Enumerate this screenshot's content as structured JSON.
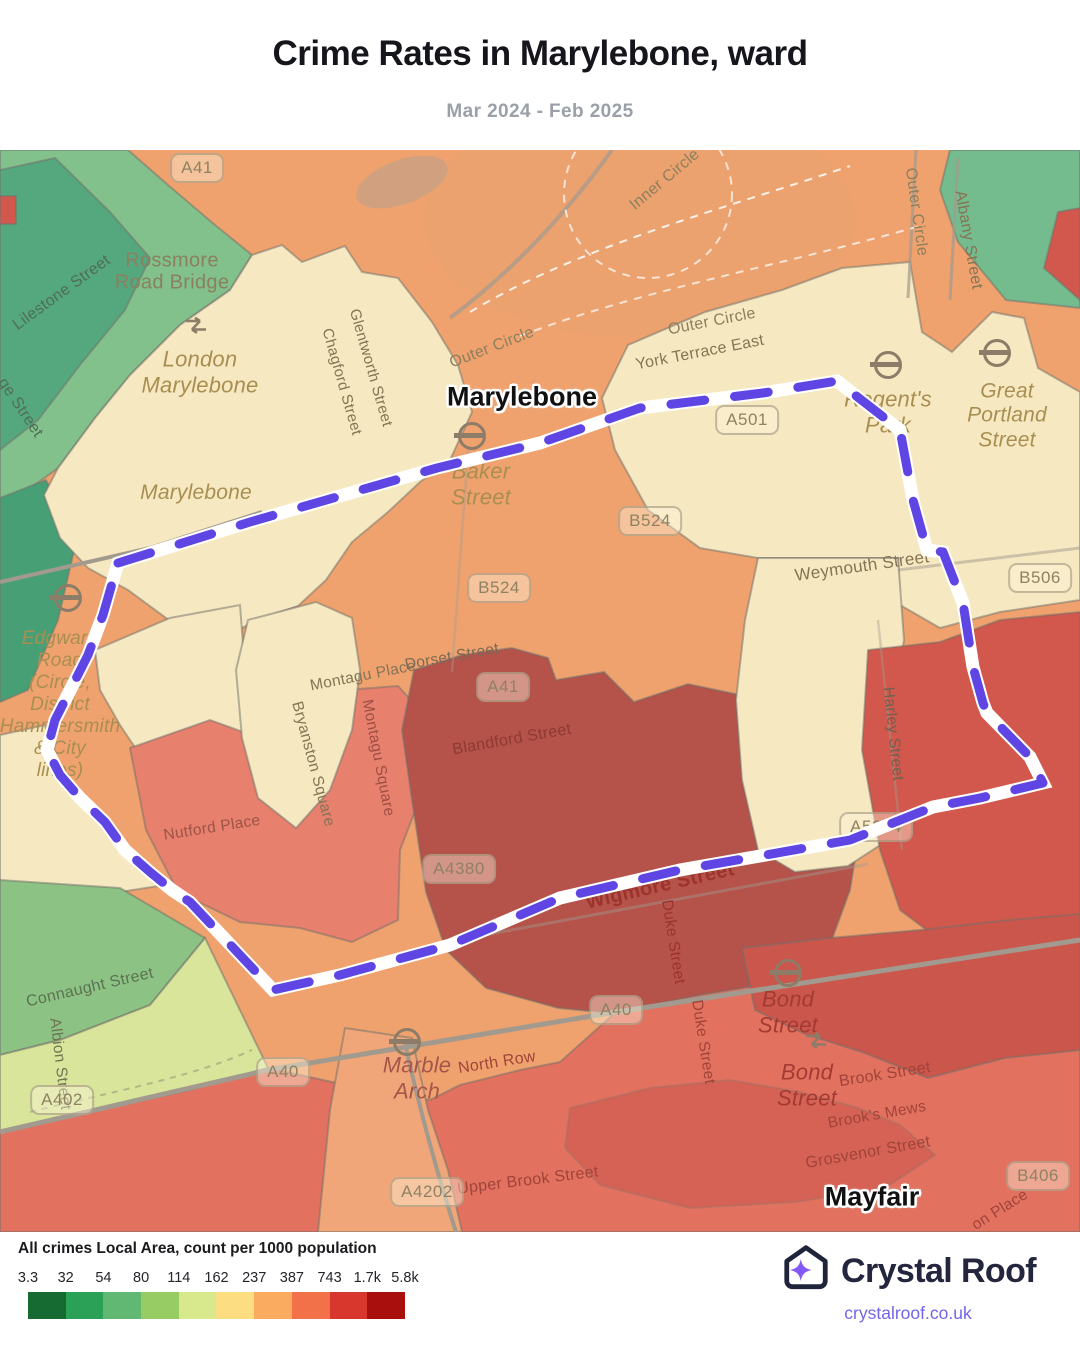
{
  "header": {
    "title": "Crime Rates in Marylebone, ward",
    "subtitle": "Mar 2024 - Feb 2025"
  },
  "map": {
    "colors": {
      "orange": "#efa26e",
      "orange_wedge": "#f0a678",
      "park": "#e7a371",
      "lake": "#c9a183",
      "cream": "#f6e8c0",
      "green_light": "#82c18c",
      "green_teal": "#55a87d",
      "green_dark": "#47a075",
      "green_tr": "#74bc8e",
      "green_bl": "#8cc384",
      "yellow_green": "#d8e59b",
      "salmon": "#e2715f",
      "salmon_light": "#e8806e",
      "red_dark": "#b5524a",
      "red_mid": "#d2574c",
      "red_bond": "#cb564c",
      "outline": "#70706a",
      "road": "#a29a8e",
      "path_dash": "#ffffff",
      "boundary": "#5e45e4",
      "boundary_casing": "#ffffff"
    },
    "area_labels": [
      {
        "n": "marylebone-area-label",
        "t": "Marylebone",
        "x": 522,
        "y": 247,
        "s": 27
      },
      {
        "n": "mayfair-area-label",
        "t": "Mayfair",
        "x": 872,
        "y": 1047,
        "s": 27
      }
    ],
    "street_labels": [
      {
        "n": "lilestone-street-label",
        "t": "Lilestone Street",
        "x": 62,
        "y": 143,
        "r": -36,
        "c": "#4f6e55",
        "s": 16
      },
      {
        "n": "ge-street-label",
        "t": "ge Street",
        "x": 20,
        "y": 258,
        "r": 56,
        "c": "#4f6e55",
        "s": 16
      },
      {
        "n": "rossmore-road-bridge-label",
        "t": "Rossmore\nRoad Bridge",
        "x": 172,
        "y": 122,
        "r": 0,
        "c": "#8a8060",
        "s": 20
      },
      {
        "n": "glentworth-street-label",
        "t": "Glentworth Street",
        "x": 370,
        "y": 218,
        "r": 74,
        "c": "#857455",
        "s": 15
      },
      {
        "n": "chagford-street-label",
        "t": "Chagford Street",
        "x": 341,
        "y": 232,
        "r": 74,
        "c": "#857455",
        "s": 15
      },
      {
        "n": "outer-circle-nw-label",
        "t": "Outer Circle",
        "x": 492,
        "y": 198,
        "r": -21,
        "c": "#8d7f5e",
        "s": 16
      },
      {
        "n": "inner-circle-label",
        "t": "Inner Circle",
        "x": 665,
        "y": 30,
        "r": -40,
        "c": "#8d7f5e",
        "s": 16
      },
      {
        "n": "outer-circle-east-label",
        "t": "Outer Circle",
        "x": 916,
        "y": 62,
        "r": 82,
        "c": "#8d7f5e",
        "s": 16
      },
      {
        "n": "albany-street-label",
        "t": "Albany Street",
        "x": 968,
        "y": 90,
        "r": 80,
        "c": "#857455",
        "s": 16
      },
      {
        "n": "outer-circle-york-label",
        "t": "Outer Circle",
        "x": 712,
        "y": 172,
        "r": -11,
        "c": "#8d7f5e",
        "s": 16
      },
      {
        "n": "york-terrace-east-label",
        "t": "York Terrace East",
        "x": 700,
        "y": 203,
        "r": -11,
        "c": "#857455",
        "s": 16
      },
      {
        "n": "weymouth-street-label",
        "t": "Weymouth Street",
        "x": 862,
        "y": 416,
        "r": -8,
        "c": "#857455",
        "s": 17
      },
      {
        "n": "montagu-place-label",
        "t": "Montagu Place",
        "x": 363,
        "y": 526,
        "r": -11,
        "c": "#857455",
        "s": 15.5
      },
      {
        "n": "dorset-street-label",
        "t": "Dorset Street",
        "x": 452,
        "y": 507,
        "r": -10,
        "c": "#7c6853",
        "s": 15.5
      },
      {
        "n": "blandford-street-label",
        "t": "Blandford Street",
        "x": 512,
        "y": 590,
        "r": -10,
        "c": "#8d3a32",
        "s": 16
      },
      {
        "n": "montagu-square-label",
        "t": "Montagu Square",
        "x": 378,
        "y": 608,
        "r": 79,
        "c": "#9c4f44",
        "s": 15.5
      },
      {
        "n": "bryanston-square-label",
        "t": "Bryanston Square",
        "x": 313,
        "y": 614,
        "r": 75,
        "c": "#857455",
        "s": 15.5
      },
      {
        "n": "nutford-place-label",
        "t": "Nutford Place",
        "x": 212,
        "y": 678,
        "r": -9,
        "c": "#9c5348",
        "s": 15.5
      },
      {
        "n": "harley-street-label",
        "t": "Harley Street",
        "x": 893,
        "y": 584,
        "r": 84,
        "c": "#6e6150",
        "s": 15.5
      },
      {
        "n": "wigmore-street-label",
        "t": "Wigmore Street",
        "x": 660,
        "y": 736,
        "r": -13,
        "c": "#9c332c",
        "s": 20,
        "w": 600
      },
      {
        "n": "duke-street-north-label",
        "t": "Duke Street",
        "x": 673,
        "y": 792,
        "r": 81,
        "c": "#9c332c",
        "s": 15.5
      },
      {
        "n": "connaught-street-label",
        "t": "Connaught Street",
        "x": 90,
        "y": 838,
        "r": -13,
        "c": "#5c7252",
        "s": 16
      },
      {
        "n": "albion-street-label",
        "t": "Albion Street",
        "x": 60,
        "y": 914,
        "r": 83,
        "c": "#6c7550",
        "s": 15.5
      },
      {
        "n": "north-row-label",
        "t": "North Row",
        "x": 497,
        "y": 913,
        "r": -9,
        "c": "#a0443a",
        "s": 16
      },
      {
        "n": "duke-street-south-label",
        "t": "Duke Street",
        "x": 703,
        "y": 892,
        "r": 81,
        "c": "#a0443a",
        "s": 15.5
      },
      {
        "n": "brook-street-label",
        "t": "Brook Street",
        "x": 885,
        "y": 925,
        "r": -9,
        "c": "#a0443a",
        "s": 16
      },
      {
        "n": "brooks-mews-label",
        "t": "Brook's Mews",
        "x": 877,
        "y": 965,
        "r": -10,
        "c": "#a0443a",
        "s": 15.5
      },
      {
        "n": "grosvenor-street-label",
        "t": "Grosvenor Street",
        "x": 868,
        "y": 1003,
        "r": -10,
        "c": "#a0443a",
        "s": 16
      },
      {
        "n": "upper-brook-street-label",
        "t": "Upper Brook Street",
        "x": 528,
        "y": 1031,
        "r": -7,
        "c": "#a0443a",
        "s": 16
      },
      {
        "n": "on-place-label",
        "t": "on Place",
        "x": 1000,
        "y": 1060,
        "r": -32,
        "c": "#a0443a",
        "s": 15.5
      }
    ],
    "station_labels": [
      {
        "n": "london-marylebone-station-label",
        "t": "London\nMarylebone",
        "x": 200,
        "y": 222,
        "s": 22
      },
      {
        "n": "marylebone-neighbourhood-label",
        "t": "Marylebone",
        "x": 196,
        "y": 343,
        "s": 21
      },
      {
        "n": "baker-street-station-label",
        "t": "Baker\nStreet",
        "x": 481,
        "y": 334,
        "s": 22
      },
      {
        "n": "regents-park-station-label",
        "t": "Regent's\nPark",
        "x": 888,
        "y": 262,
        "s": 22
      },
      {
        "n": "great-portland-street-station-label",
        "t": "Great\nPortland\nStreet",
        "x": 1007,
        "y": 266,
        "s": 21
      },
      {
        "n": "edgware-road-station-label",
        "t": "Edgware\nRoad\n(Circle,\nDistrict\nHammersmith\n& City\nlines)",
        "x": 60,
        "y": 555,
        "s": 19
      },
      {
        "n": "marble-arch-station-label",
        "t": "Marble\nArch",
        "x": 417,
        "y": 928,
        "s": 22,
        "c": "#a5564b"
      },
      {
        "n": "bond-street-station-label",
        "t": "Bond\nStreet",
        "x": 788,
        "y": 862,
        "s": 22,
        "c": "#a33b33"
      },
      {
        "n": "bond-street-station-label-2",
        "t": "Bond\nStreet",
        "x": 807,
        "y": 935,
        "s": 22,
        "c": "#a33b33"
      }
    ],
    "road_badges": [
      {
        "n": "badge-a41-north",
        "t": "A41",
        "x": 197,
        "y": 18
      },
      {
        "n": "badge-a41-central",
        "t": "A41",
        "x": 503,
        "y": 537
      },
      {
        "n": "badge-a501",
        "t": "A501",
        "x": 747,
        "y": 270
      },
      {
        "n": "badge-b524-east",
        "t": "B524",
        "x": 650,
        "y": 371
      },
      {
        "n": "badge-b524-west",
        "t": "B524",
        "x": 499,
        "y": 438
      },
      {
        "n": "badge-b506",
        "t": "B506",
        "x": 1040,
        "y": 428
      },
      {
        "n": "badge-a4380",
        "t": "A4380",
        "x": 459,
        "y": 719
      },
      {
        "n": "badge-a5204",
        "t": "A5204",
        "x": 876,
        "y": 677
      },
      {
        "n": "badge-a40-east",
        "t": "A40",
        "x": 616,
        "y": 860
      },
      {
        "n": "badge-a40-west",
        "t": "A40",
        "x": 283,
        "y": 922
      },
      {
        "n": "badge-a402",
        "t": "A402",
        "x": 62,
        "y": 950
      },
      {
        "n": "badge-a4202",
        "t": "A4202",
        "x": 427,
        "y": 1042
      },
      {
        "n": "badge-b406",
        "t": "B406",
        "x": 1038,
        "y": 1026
      }
    ],
    "transit_icons": [
      {
        "type": "rail",
        "n": "london-marylebone-rail-icon",
        "x": 196,
        "y": 178
      },
      {
        "type": "roundel",
        "n": "baker-street-tube-icon",
        "x": 472,
        "y": 286
      },
      {
        "type": "roundel",
        "n": "regents-park-tube-icon",
        "x": 888,
        "y": 215
      },
      {
        "type": "roundel",
        "n": "great-portland-street-tube-icon",
        "x": 997,
        "y": 203
      },
      {
        "type": "roundel",
        "n": "edgware-road-tube-icon",
        "x": 68,
        "y": 448
      },
      {
        "type": "roundel",
        "n": "bond-street-tube-icon",
        "x": 788,
        "y": 823
      },
      {
        "type": "rail",
        "n": "bond-street-rail-icon",
        "x": 816,
        "y": 893
      },
      {
        "type": "roundel",
        "n": "marble-arch-tube-icon",
        "x": 407,
        "y": 892
      }
    ]
  },
  "legend": {
    "title": "All crimes Local Area, count per 1000 population",
    "stops": [
      "3.3",
      "32",
      "54",
      "80",
      "114",
      "162",
      "237",
      "387",
      "743",
      "1.7k",
      "5.8k"
    ],
    "colors": [
      "#156b31",
      "#2aa157",
      "#60b873",
      "#97cc64",
      "#d7e98c",
      "#fcdd82",
      "#fbab60",
      "#f37148",
      "#d8372e",
      "#a90f0c"
    ]
  },
  "footer": {
    "brand": "Crystal Roof",
    "link": "crystalroof.co.uk",
    "brand_color": "#23263d",
    "star_color": "#8458f5",
    "link_color": "#7365e8"
  }
}
